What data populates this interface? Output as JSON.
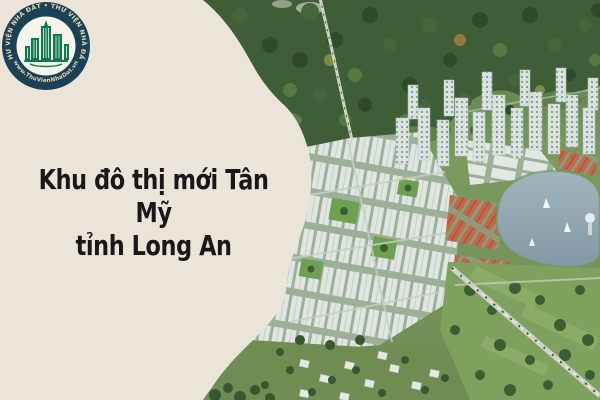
{
  "headline": {
    "line1": "Khu đô thị mới Tân Mỹ",
    "line2": "tỉnh Long An",
    "text_color": "#181818"
  },
  "logo": {
    "arc_text_top": "THƯ VIỆN NHÀ ĐẤT • THƯ VIỆN NHÀ ĐẤT",
    "arc_text_bottom": "★ www.ThuVienNhaDat.vn ★",
    "colors": {
      "ring": "#1a4156",
      "inner_circle": "#f7f4ec",
      "building": "#0e7a4e",
      "arc_text": "#e6d9ae"
    }
  },
  "panel": {
    "background_color": "#eae5d8"
  },
  "scene": {
    "type": "aerial-masterplan-render",
    "colors": {
      "forest": "#3f5d36",
      "field": "#7fa15e",
      "water": "#94a8b3",
      "white_roofs": "#dfe5e0",
      "red_roofs": "#c1694a",
      "towers": "#d9e2de",
      "road": "#ccd2c6"
    }
  }
}
